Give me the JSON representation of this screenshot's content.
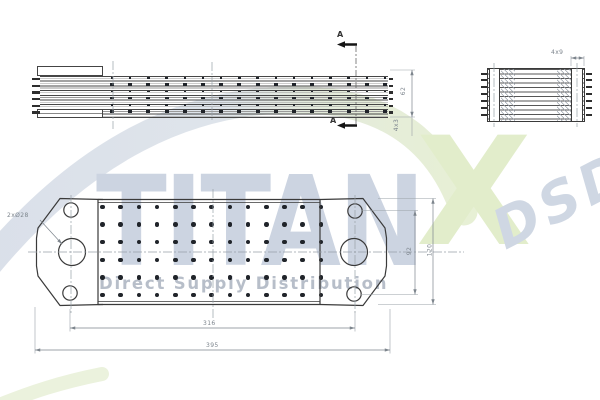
{
  "meta": {
    "kind": "technical drawing",
    "subject": "plate oil cooler, three orthographic views"
  },
  "watermark": {
    "brand": "TITAN",
    "brand_x": "X",
    "suffix": "DSD",
    "tagline": "Direct Supply Distribution",
    "colors": {
      "steel_text": "#ccd4e1",
      "green_x": "#e2edcb",
      "suffix_text": "#cfd7e3",
      "tagline_text": "#b7bec9",
      "swoosh_steel": "#d8dee8",
      "swoosh_green": "#e6efd3"
    }
  },
  "drawing": {
    "section_label": "A",
    "hole_callout": "2xØ28",
    "dimensions": {
      "side_stack_height": "62",
      "side_plate_pitch": "4x3",
      "end_plate_width": "4x9",
      "plan_bolt_span": "92",
      "plan_height": "120",
      "plan_port_span": "316",
      "plan_length": "395"
    },
    "colors": {
      "line": "#3a3a3a",
      "dim_line": "#8a8a8a",
      "dot": "#20242a",
      "centerline": "#98a0a8"
    },
    "plan_dot_grid": {
      "cols": 13,
      "rows": 6,
      "x0": 102.5,
      "y0": 207,
      "dx": 18.2,
      "dy": 17.6,
      "d": 4.6
    },
    "side_dot_grid": {
      "cols": 16,
      "x0": 112,
      "dx": 18.2,
      "rows": [
        {
          "y": 78.0,
          "w": 2.6,
          "h": 1.8
        },
        {
          "y": 84.7,
          "w": 4.2,
          "h": 2.6
        },
        {
          "y": 91.4,
          "w": 2.6,
          "h": 1.8
        },
        {
          "y": 98.1,
          "w": 4.2,
          "h": 2.6
        },
        {
          "y": 104.8,
          "w": 2.6,
          "h": 1.8
        },
        {
          "y": 111.5,
          "w": 4.2,
          "h": 2.6
        }
      ]
    },
    "side_nubs": {
      "ys": [
        77.8,
        84.5,
        91.2,
        97.9,
        104.6,
        111.3
      ],
      "left_x": 31.5,
      "left_w": 8,
      "right_x": 388.5,
      "right_w": 4.5,
      "h": 2.4
    },
    "end_nubs": {
      "ys": [
        72.5,
        79.3,
        86.1,
        92.9,
        99.7,
        106.5,
        114.0
      ],
      "left_x": 481,
      "right_x": 585.5,
      "w": 6,
      "h": 2.2
    }
  }
}
